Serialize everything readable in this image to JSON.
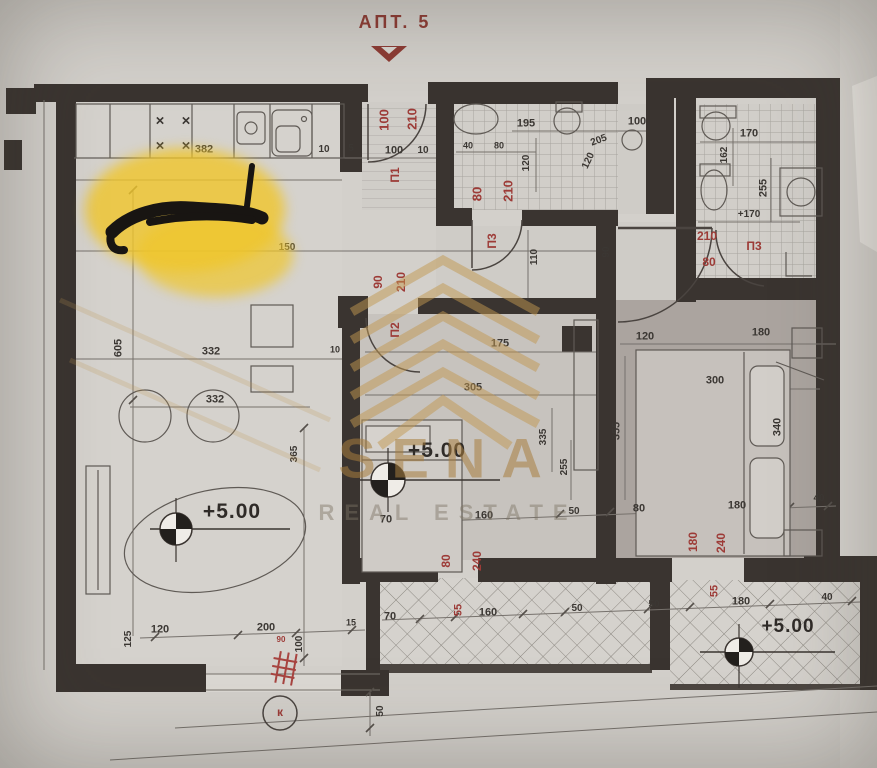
{
  "title": {
    "label": "АПТ. 5"
  },
  "watermark": {
    "line1": "SENA",
    "line2": "REAL ESTATE"
  },
  "levels": [
    {
      "text": "+5.00",
      "x": 232,
      "y": 512,
      "s": 21
    },
    {
      "text": "+5.00",
      "x": 437,
      "y": 451,
      "s": 21
    },
    {
      "text": "+5.00",
      "x": 788,
      "y": 627,
      "s": 19
    }
  ],
  "dimensions": [
    {
      "t": "382",
      "x": 204,
      "y": 150
    },
    {
      "t": "10",
      "x": 324,
      "y": 150,
      "s": 10
    },
    {
      "t": "5",
      "x": 351,
      "y": 149,
      "s": 10
    },
    {
      "t": "100",
      "x": 394,
      "y": 151
    },
    {
      "t": "10",
      "x": 423,
      "y": 151,
      "s": 10
    },
    {
      "t": "100",
      "x": 384,
      "y": 120,
      "r": -90,
      "c": "red",
      "s": 13
    },
    {
      "t": "210",
      "x": 412,
      "y": 119,
      "r": -90,
      "c": "red",
      "s": 13
    },
    {
      "t": "П1",
      "x": 395,
      "y": 175,
      "r": -90,
      "c": "red",
      "s": 12
    },
    {
      "t": "80",
      "x": 477,
      "y": 194,
      "r": -90,
      "c": "red",
      "s": 13
    },
    {
      "t": "210",
      "x": 508,
      "y": 191,
      "r": -90,
      "c": "red",
      "s": 13
    },
    {
      "t": "195",
      "x": 526,
      "y": 124
    },
    {
      "t": "40",
      "x": 468,
      "y": 146,
      "s": 9
    },
    {
      "t": "80",
      "x": 499,
      "y": 146,
      "s": 9
    },
    {
      "t": "120",
      "x": 527,
      "y": 163,
      "r": -90,
      "s": 10
    },
    {
      "t": "120",
      "x": 589,
      "y": 161,
      "r": -65,
      "s": 10
    },
    {
      "t": "205",
      "x": 599,
      "y": 141,
      "r": -20,
      "s": 10
    },
    {
      "t": "100",
      "x": 637,
      "y": 122
    },
    {
      "t": "170",
      "x": 749,
      "y": 134
    },
    {
      "t": "162",
      "x": 725,
      "y": 155,
      "r": -90,
      "s": 10
    },
    {
      "t": "255",
      "x": 764,
      "y": 188,
      "r": -90
    },
    {
      "t": "+170",
      "x": 749,
      "y": 215,
      "s": 10
    },
    {
      "t": "210",
      "x": 707,
      "y": 236,
      "c": "red",
      "s": 12
    },
    {
      "t": "80",
      "x": 709,
      "y": 262,
      "c": "red",
      "s": 12
    },
    {
      "t": "П3",
      "x": 754,
      "y": 246,
      "c": "red",
      "s": 12
    },
    {
      "t": "П3",
      "x": 492,
      "y": 241,
      "r": -90,
      "c": "red",
      "s": 12
    },
    {
      "t": "110",
      "x": 535,
      "y": 257,
      "r": -90,
      "s": 10
    },
    {
      "t": "90",
      "x": 607,
      "y": 252,
      "r": -90,
      "s": 10
    },
    {
      "t": "150",
      "x": 287,
      "y": 248,
      "s": 10
    },
    {
      "t": "×",
      "x": 160,
      "y": 121,
      "s": 15
    },
    {
      "t": "×",
      "x": 186,
      "y": 121,
      "s": 15
    },
    {
      "t": "×",
      "x": 160,
      "y": 146,
      "s": 15
    },
    {
      "t": "×",
      "x": 186,
      "y": 146,
      "s": 15
    },
    {
      "t": "605",
      "x": 119,
      "y": 348,
      "r": -90
    },
    {
      "t": "332",
      "x": 211,
      "y": 352
    },
    {
      "t": "332",
      "x": 215,
      "y": 400
    },
    {
      "t": "10",
      "x": 335,
      "y": 350,
      "s": 9
    },
    {
      "t": "90",
      "x": 378,
      "y": 282,
      "r": -90,
      "c": "red",
      "s": 12
    },
    {
      "t": "210",
      "x": 401,
      "y": 282,
      "r": -90,
      "c": "red",
      "s": 12
    },
    {
      "t": "П2",
      "x": 395,
      "y": 330,
      "r": -90,
      "c": "red",
      "s": 12
    },
    {
      "t": "175",
      "x": 500,
      "y": 344
    },
    {
      "t": "305",
      "x": 473,
      "y": 388
    },
    {
      "t": "120",
      "x": 645,
      "y": 337
    },
    {
      "t": "180",
      "x": 761,
      "y": 333
    },
    {
      "t": "300",
      "x": 715,
      "y": 381
    },
    {
      "t": "340",
      "x": 778,
      "y": 427,
      "r": -90
    },
    {
      "t": "355",
      "x": 617,
      "y": 431,
      "r": -90
    },
    {
      "t": "335",
      "x": 544,
      "y": 437,
      "r": -90,
      "s": 10
    },
    {
      "t": "255",
      "x": 565,
      "y": 467,
      "r": -90,
      "s": 10
    },
    {
      "t": "365",
      "x": 295,
      "y": 454,
      "r": -90,
      "s": 10
    },
    {
      "t": "70",
      "x": 386,
      "y": 520
    },
    {
      "t": "160",
      "x": 484,
      "y": 516
    },
    {
      "t": "50",
      "x": 574,
      "y": 512,
      "s": 10
    },
    {
      "t": "80",
      "x": 639,
      "y": 509
    },
    {
      "t": "180",
      "x": 737,
      "y": 506
    },
    {
      "t": "40",
      "x": 819,
      "y": 499,
      "s": 10
    },
    {
      "t": "80",
      "x": 446,
      "y": 561,
      "r": -90,
      "c": "red",
      "s": 12
    },
    {
      "t": "240",
      "x": 477,
      "y": 561,
      "r": -90,
      "c": "red",
      "s": 12
    },
    {
      "t": "180",
      "x": 693,
      "y": 542,
      "r": -90,
      "c": "red",
      "s": 12
    },
    {
      "t": "240",
      "x": 721,
      "y": 543,
      "r": -90,
      "c": "red",
      "s": 12
    },
    {
      "t": "125",
      "x": 129,
      "y": 639,
      "r": -90,
      "s": 10
    },
    {
      "t": "120",
      "x": 160,
      "y": 630
    },
    {
      "t": "200",
      "x": 266,
      "y": 628
    },
    {
      "t": "90",
      "x": 281,
      "y": 640,
      "c": "red",
      "s": 8
    },
    {
      "t": "100",
      "x": 300,
      "y": 644,
      "r": -90,
      "s": 10
    },
    {
      "t": "15",
      "x": 351,
      "y": 623,
      "s": 9
    },
    {
      "t": "70",
      "x": 390,
      "y": 617
    },
    {
      "t": "55",
      "x": 459,
      "y": 610,
      "r": -90,
      "c": "red"
    },
    {
      "t": "160",
      "x": 488,
      "y": 613
    },
    {
      "t": "50",
      "x": 577,
      "y": 609,
      "s": 10
    },
    {
      "t": "50",
      "x": 654,
      "y": 605,
      "s": 10
    },
    {
      "t": "55",
      "x": 715,
      "y": 591,
      "r": -90,
      "c": "red"
    },
    {
      "t": "180",
      "x": 741,
      "y": 602
    },
    {
      "t": "40",
      "x": 827,
      "y": 598,
      "s": 10
    },
    {
      "t": "50",
      "x": 381,
      "y": 711,
      "r": -90,
      "s": 10
    },
    {
      "t": "к",
      "x": 280,
      "y": 712,
      "c": "red",
      "s": 12
    }
  ]
}
